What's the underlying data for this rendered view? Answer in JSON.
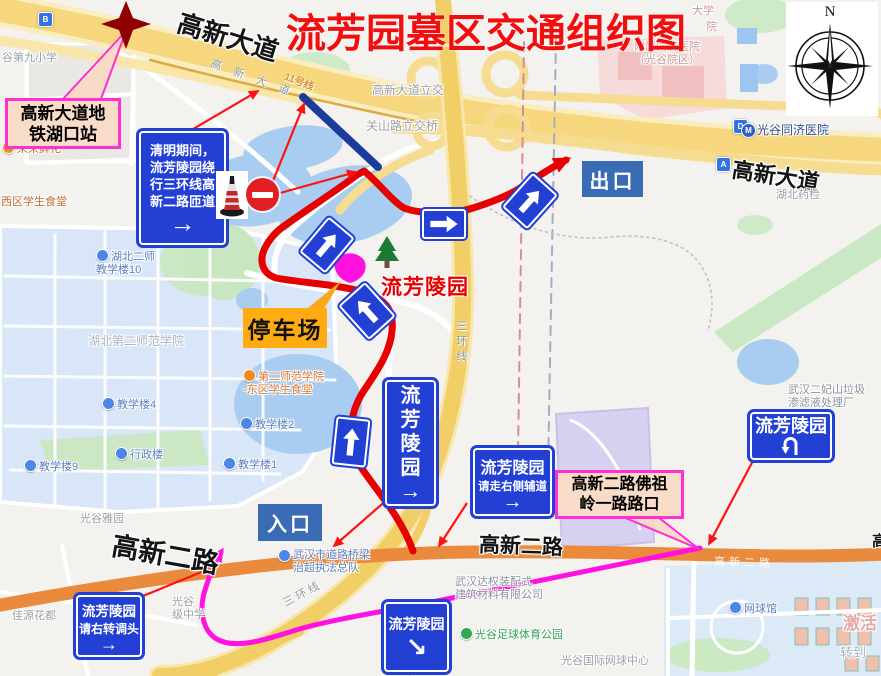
{
  "title": "流芳园墓区交通组织图",
  "compass_n": "N",
  "colors": {
    "title_red": "#F10E0E",
    "route_red": "#E60000",
    "thin_red": "#FF1212",
    "detour_magenta": "#FF12DF",
    "sign_blue": "#2240D4",
    "label_box_blue": "#3A6BB5",
    "callout_border": "#FF2FD2",
    "callout_fill": "#F8DCC7",
    "parking_orange": "#FFAC12"
  },
  "signs": {
    "qingming": {
      "l1": "清明期间，",
      "l2": "流芳陵园绕",
      "l3": "行三环线高",
      "l4": "新二路匝道",
      "arrow": "→"
    },
    "exit": "出口",
    "entrance": "入口",
    "parking": "停车场",
    "cemetery_red_label": "流芳陵园",
    "vertical": {
      "c1": "流",
      "c2": "芳",
      "c3": "陵",
      "c4": "园",
      "arrow": "→"
    },
    "side_road": {
      "l1": "流芳陵园",
      "l2": "请走右侧辅道",
      "arrow": "→"
    },
    "down_right": {
      "l1": "流芳陵园",
      "arrow": "↘"
    },
    "uturn": {
      "l1": "流芳陵园"
    },
    "right_turn": {
      "l1": "流芳陵园",
      "l2": "请右转调头",
      "arrow": "→"
    }
  },
  "callouts": {
    "metro": {
      "l1": "高新大道地",
      "l2": "铁湖口站"
    },
    "intersection": {
      "l1": "高新二路佛祖",
      "l2": "岭一路路口"
    }
  },
  "road_labels": {
    "gaoxin_avenue_nw": "高新大道",
    "gaoxin_avenue_e": "高新大道",
    "gaoxin2_w": "高新二路",
    "gaoxin2_c": "高新二路",
    "gaoxin2_partial_e": "高",
    "gaoxin_gray": "高 新 大 道",
    "line11": "11号线",
    "sanhuan_v": "三环线",
    "sanhuan_sw": "三环线",
    "gaoxin2_on_road": "高新二路"
  },
  "metro_entrances": {
    "b": "B",
    "d": "D",
    "a": "A",
    "m": "M"
  },
  "pois": [
    {
      "text": "谷第九小学"
    },
    {
      "text": "荣荣鲜花"
    },
    {
      "text": "西区学生食堂"
    },
    {
      "text": "湖北二师\n教学楼10"
    },
    {
      "text": "湖北第二师范学院"
    },
    {
      "text": "第二师范学院\n-东区学生食堂"
    },
    {
      "text": "教学楼4"
    },
    {
      "text": "教学楼2"
    },
    {
      "text": "教学楼9"
    },
    {
      "text": "行政楼"
    },
    {
      "text": "教学楼1"
    },
    {
      "text": "光谷雅园"
    },
    {
      "text": "佳源花都"
    },
    {
      "text": "光谷\n级中学"
    },
    {
      "text": "武汉市道路桥梁\n治超执法总队"
    },
    {
      "text": "武汉达权装配式\n建筑材料有限公司"
    },
    {
      "text": "光谷足球体育公园"
    },
    {
      "text": "光谷国际网球中心"
    },
    {
      "text": "网球馆"
    },
    {
      "text": "武汉二妃山垃圾\n渗滤液处理厂"
    },
    {
      "text": "大学"
    },
    {
      "text": "院"
    },
    {
      "text": "附属同济医院\n（光谷院区）"
    },
    {
      "text": "光谷同济医院"
    },
    {
      "text": "湖北药检"
    },
    {
      "text": "高新大道立交"
    },
    {
      "text": "关山路立交桥"
    },
    {
      "text": "激活"
    },
    {
      "text": "转到"
    }
  ]
}
